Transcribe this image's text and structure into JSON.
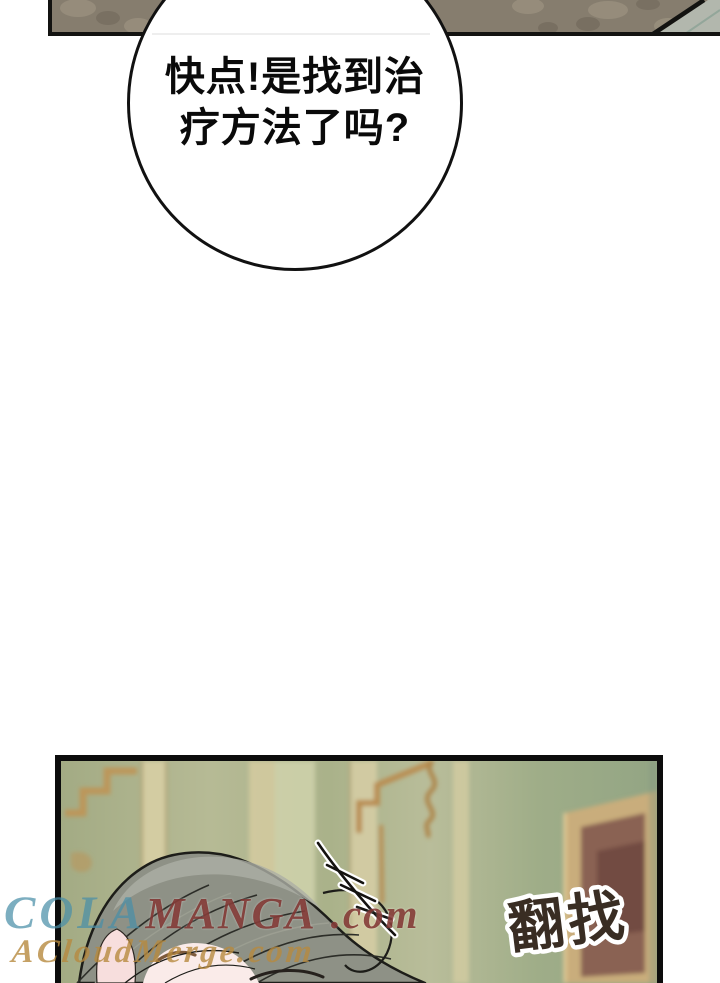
{
  "bubble": {
    "line1": "快点!是找到治",
    "line2": "疗方法了吗?"
  },
  "bottom_panel": {
    "sfx": "翻找"
  },
  "watermarks": {
    "site1_script": "COLA",
    "site1_name": "MANGA",
    "site1_tld": ".com",
    "site2": "ACloudMerge.com"
  },
  "colors": {
    "strip_olive": "#867d6e",
    "strip_corner_light": "#b2b7ad",
    "wall_green": "#aab28a",
    "molding_gold": "#bf9355",
    "pilaster_cream": "#d9d0a6",
    "frame_tan": "#c9ad7b",
    "painting_maroon": "#8a6252",
    "hair_grey": "#8e9186",
    "skin_pink": "#f7dedd",
    "sfx_ink": "#392d23",
    "outline_black": "#111111",
    "watermark_teal": "#4a8fa8",
    "watermark_red": "#7a2a26",
    "watermark_tan": "#b6893f"
  }
}
